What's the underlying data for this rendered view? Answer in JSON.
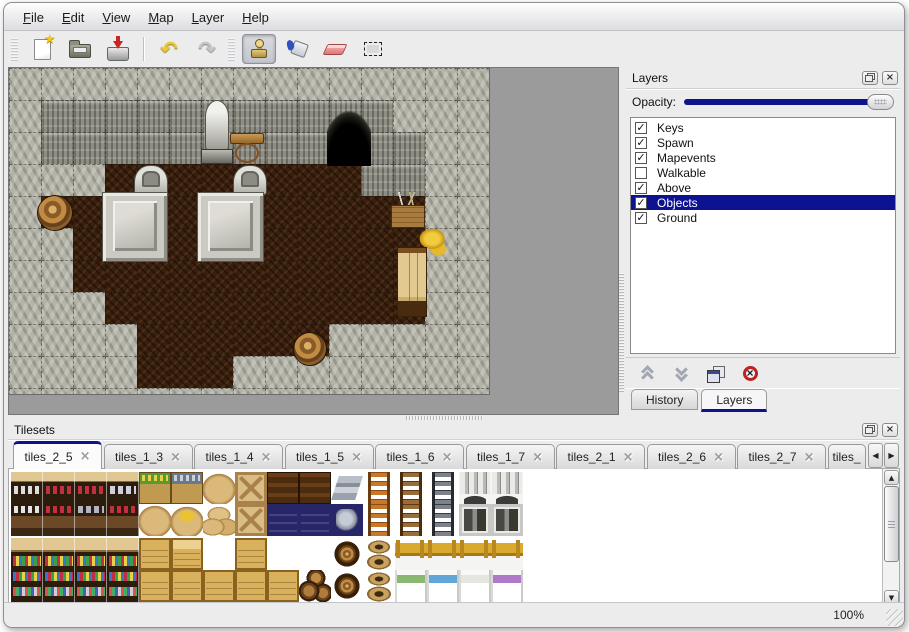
{
  "colors": {
    "accent": "#10128c",
    "selection": "#0c1290",
    "window_bg": "#ececec",
    "map_bg": "#9b9b9b"
  },
  "menu_bar": {
    "items": [
      "File",
      "Edit",
      "View",
      "Map",
      "Layer",
      "Help"
    ]
  },
  "toolbar": {
    "items": [
      {
        "kind": "handle"
      },
      {
        "kind": "button",
        "name": "new-file-button",
        "icon": "new"
      },
      {
        "kind": "button",
        "name": "open-file-button",
        "icon": "open"
      },
      {
        "kind": "button",
        "name": "save-file-button",
        "icon": "save"
      },
      {
        "kind": "sep"
      },
      {
        "kind": "button",
        "name": "undo-button",
        "icon": "undo",
        "glyph": "↶"
      },
      {
        "kind": "button",
        "name": "redo-button",
        "icon": "redo",
        "glyph": "↷"
      },
      {
        "kind": "handle"
      },
      {
        "kind": "button",
        "name": "stamp-tool-button",
        "icon": "stamp",
        "active": true
      },
      {
        "kind": "button",
        "name": "fill-tool-button",
        "icon": "fill"
      },
      {
        "kind": "button",
        "name": "eraser-tool-button",
        "icon": "eraser"
      },
      {
        "kind": "button",
        "name": "select-tool-button",
        "icon": "select"
      }
    ]
  },
  "map": {
    "tile_size": 32,
    "cols": 15,
    "rows": 11,
    "legend": {
      "C": "cliff-rock",
      "W": "rock-wall-face",
      "F": "dark-floor"
    },
    "grid": [
      "CCCCCCCCCCCCCCC",
      "CWWWWWWWWWWWCCC",
      "CWWWWWWWWWWWWCC",
      "CCCFFFFFFFFWWCC",
      "CFFFFFFFFFFFFCC",
      "CCFFFFFFFFFFFCC",
      "CCFFFFFFFFFFFCC",
      "CCCFFFFFFFFFFCC",
      "CCCCFFFFFFCCCCC",
      "CCCCFFFCCCCCCCC",
      "CCCCCCCCCCCCCCC"
    ],
    "objects": [
      {
        "type": "cave",
        "name": "cave-entrance",
        "x": 318,
        "y": 30,
        "w": 44,
        "h": 68
      },
      {
        "type": "statue",
        "name": "statue",
        "x": 189,
        "y": 32,
        "w": 38,
        "h": 64
      },
      {
        "type": "table",
        "name": "wooden-table",
        "x": 221,
        "y": 65,
        "w": 34,
        "h": 31
      },
      {
        "type": "grave",
        "name": "gravestone",
        "x": 125,
        "y": 97,
        "w": 34,
        "h": 30
      },
      {
        "type": "grave",
        "name": "gravestone",
        "x": 224,
        "y": 97,
        "w": 34,
        "h": 30
      },
      {
        "type": "platform",
        "name": "stone-platform",
        "x": 94,
        "y": 125,
        "w": 64,
        "h": 68
      },
      {
        "type": "platform",
        "name": "stone-platform",
        "x": 189,
        "y": 125,
        "w": 65,
        "h": 68
      },
      {
        "type": "barrel",
        "name": "barrel",
        "x": 29,
        "y": 128,
        "w": 34,
        "h": 34
      },
      {
        "type": "crate",
        "name": "supply-crate",
        "x": 382,
        "y": 124,
        "w": 34,
        "h": 36
      },
      {
        "type": "horn",
        "name": "golden-horn",
        "x": 407,
        "y": 158,
        "w": 36,
        "h": 32
      },
      {
        "type": "cabinet",
        "name": "tall-cabinet",
        "x": 388,
        "y": 179,
        "w": 30,
        "h": 70
      },
      {
        "type": "barrel",
        "name": "barrel",
        "x": 285,
        "y": 265,
        "w": 32,
        "h": 32
      }
    ]
  },
  "layers_panel": {
    "title": "Layers",
    "opacity_label": "Opacity:",
    "opacity_value": 100,
    "layers": [
      {
        "name": "Keys",
        "checked": true,
        "selected": false
      },
      {
        "name": "Spawn",
        "checked": true,
        "selected": false
      },
      {
        "name": "Mapevents",
        "checked": true,
        "selected": false
      },
      {
        "name": "Walkable",
        "checked": false,
        "selected": false
      },
      {
        "name": "Above",
        "checked": true,
        "selected": false
      },
      {
        "name": "Objects",
        "checked": true,
        "selected": true
      },
      {
        "name": "Ground",
        "checked": true,
        "selected": false
      }
    ],
    "buttons": [
      {
        "name": "move-layer-up-button",
        "icon": "up"
      },
      {
        "name": "move-layer-down-button",
        "icon": "down"
      },
      {
        "name": "duplicate-layer-button",
        "icon": "copy"
      },
      {
        "name": "delete-layer-button",
        "icon": "delete"
      }
    ],
    "tabs": [
      {
        "label": "History",
        "active": false
      },
      {
        "label": "Layers",
        "active": true
      }
    ]
  },
  "tilesets_panel": {
    "title": "Tilesets",
    "tabs": [
      {
        "label": "tiles_2_5",
        "active": true
      },
      {
        "label": "tiles_1_3",
        "active": false
      },
      {
        "label": "tiles_1_4",
        "active": false
      },
      {
        "label": "tiles_1_5",
        "active": false
      },
      {
        "label": "tiles_1_6",
        "active": false
      },
      {
        "label": "tiles_1_7",
        "active": false
      },
      {
        "label": "tiles_2_1",
        "active": false
      },
      {
        "label": "tiles_2_6",
        "active": false
      },
      {
        "label": "tiles_2_7",
        "active": false
      },
      {
        "label": "tiles_",
        "active": false,
        "partial": true
      }
    ],
    "tile_rows": [
      [
        "shelfA_top_w",
        "shelfA_top_r",
        "shelfA_top_r",
        "shelfA_top_j",
        "box_veg",
        "box_fish",
        "sack",
        "crate_x",
        "crate_dark",
        "crate_dark",
        "metal",
        "ladder_o",
        "ladder_b",
        "ladder_g",
        "arch",
        "arch",
        ""
      ],
      [
        "shelfA_bot_w",
        "shelfA_bot_r",
        "shelfA_bot_p",
        "shelfA_bot_r",
        "sack",
        "sack_open",
        "sack_pile",
        "crate_x",
        "navy",
        "navy",
        "navy_metal",
        "ladder_o",
        "ladder_b",
        "ladder_g",
        "door",
        "door",
        ""
      ],
      [
        "shelfB_top",
        "shelfB_top",
        "shelfB_top",
        "shelfB_top",
        "crate",
        "crate_open",
        "",
        "crate",
        "",
        "",
        "barrel_side",
        "pots",
        "bed_head",
        "bed_head",
        "bed_head",
        "bed_head",
        ""
      ],
      [
        "shelfB_bot",
        "shelfB_bot",
        "shelfB_bot",
        "shelfB_bot",
        "crate",
        "crate",
        "crate",
        "crate",
        "crate",
        "barrels",
        "barrel_side",
        "pots",
        "bed_g",
        "bed_b",
        "bed_w",
        "bed_p",
        ""
      ]
    ]
  },
  "status_bar": {
    "zoom": "100%"
  }
}
